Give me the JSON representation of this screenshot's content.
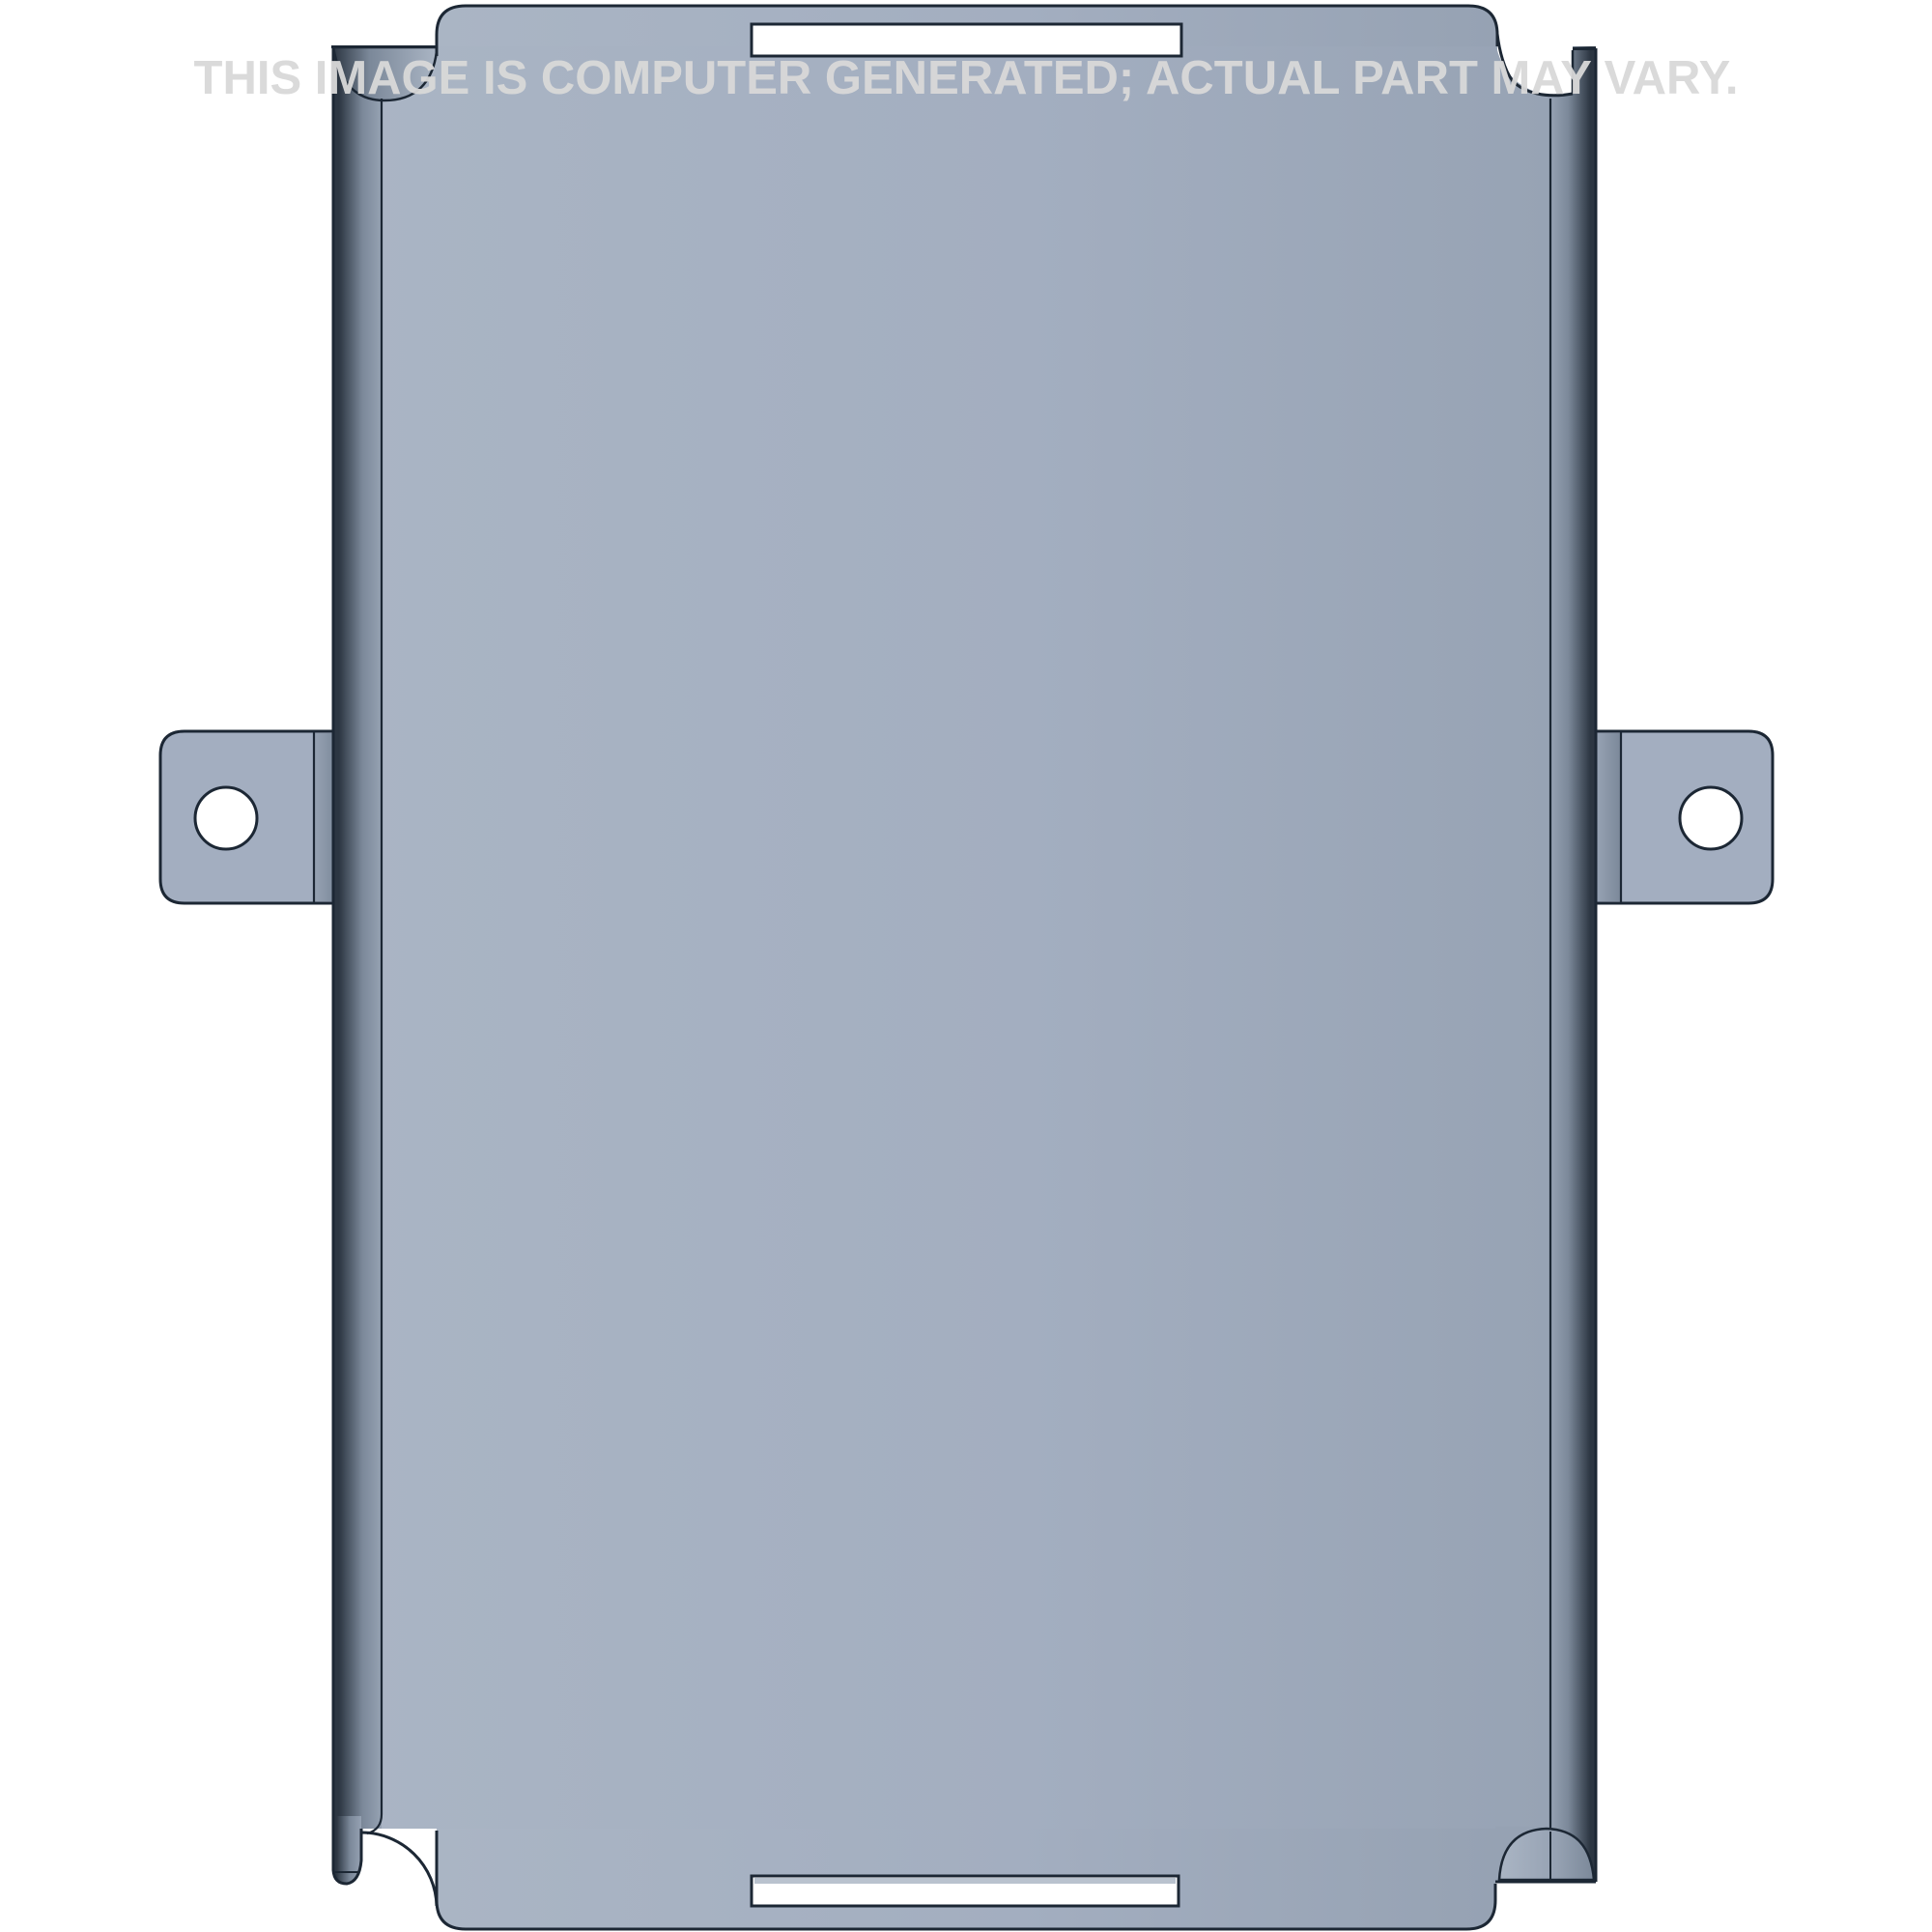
{
  "watermark": {
    "text": "THIS IMAGE IS COMPUTER GENERATED; ACTUAL PART MAY VARY."
  },
  "part": {
    "name": "sheet-metal-bracket-cad-render",
    "features": {
      "mounting_holes": 2,
      "slots": 2,
      "mounting_tabs": 2
    }
  },
  "colors": {
    "background": "#ffffff",
    "face": "#a3aec0",
    "faceLight": "#aab5c4",
    "faceDark": "#96a2b3",
    "bandMid": "#7b8899",
    "bandDark": "#2c3642",
    "edge": "#1c2734",
    "cutout": "#ffffff",
    "slotShade": "#b9c2ce",
    "watermark": "#d9d9d9"
  }
}
